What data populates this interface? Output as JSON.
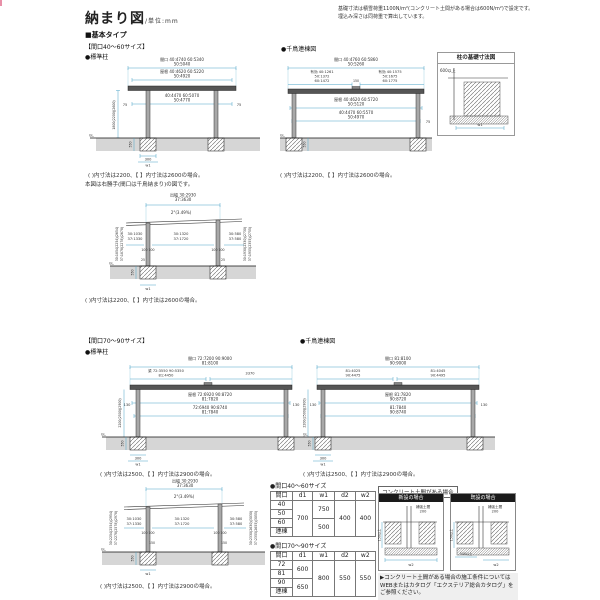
{
  "header": {
    "title": "納まり図",
    "unit": "/単位:mm",
    "note1": "基礎寸法は積雪荷重1100N/m²(コンクリート土間がある場合は600N/m²)で設定です。",
    "note2": "埋込み深さは同荷重で算出しています。"
  },
  "sections": {
    "basic": "■基本タイプ",
    "size4060": "【間口40～60サイズ】",
    "size7090": "【間口70～90サイズ】",
    "std_post": "●標準柱",
    "renketsu": "●千鳥連棟図",
    "std_post2": "●標準柱",
    "renketsu2": "●千鳥連棟図",
    "side_note": "本図は右勝手(間口は千鳥納まり)の図です。"
  },
  "d1": {
    "dim1a": "間口 40:4740 60:5340",
    "dim1b": "50:5040",
    "dim2a": "屋根 40:4620 60:5220",
    "dim2b": "50:4920",
    "dim3a": "40:4470 60:5070",
    "dim3b": "50:4770",
    "oh_l": "75",
    "oh_r": "75",
    "height": "1800(2200)(2600)",
    "gl": "GL.",
    "depth": "550",
    "base": "300",
    "w": "w1",
    "note": "( )内寸法は2200、【 】内寸法は2600の場合。"
  },
  "d2": {
    "dim1a": "間口 40:4760 60:5860",
    "dim1b": "50:5260",
    "subl1": "有効 40:1261",
    "subl2": "50:1372",
    "subl3": "60:1472",
    "subr1": "有効 40:1575",
    "subr2": "50:1675",
    "subr3": "60:1775",
    "mid": "150",
    "dim2a": "屋根 40:4620 60:5720",
    "dim2b": "50:5120",
    "dim3a": "40:4470 60:5570",
    "dim3b": "50:4970",
    "oh_r": "75",
    "gl": "GL.",
    "depth": "550",
    "note": "( )内寸法は2200、【 】内寸法は2600の場合。"
  },
  "detail": {
    "title": "柱の基礎寸法図",
    "min": "600以上",
    "w": "w1"
  },
  "d3": {
    "dim1a": "出幅 30:2930",
    "dim1b": "37:3630",
    "slope": "2°(3.49%)",
    "sl1": "30:1030",
    "sl2": "37:1330",
    "sc1": "30:1320",
    "sc2": "37:1720",
    "sr1": "30:580",
    "sr2": "37:580",
    "p1": "100  100",
    "p2": "100  100",
    "p25l": "25",
    "p25r": "25",
    "rotl1": "30:1854(2254)(2654)",
    "rotl2": "37:1878(2278)(2678)",
    "rotr1": "30:1930(2330)(2730)",
    "rotr2": "37:1955(2355)(2755)",
    "gl": "GL.",
    "depth": "550",
    "w": "w1",
    "note": "( )内寸法は2200、【 】内寸法は2600の場合。"
  },
  "d4l": {
    "dim1a": "間口 72:7200 90:9000",
    "dim1b": "81:8100",
    "subl1": "梁 72:3550 90:5350",
    "subl2": "81:4450",
    "subr": "3370",
    "dim2a": "屋根 72:6920 90:8720",
    "dim2b": "81:7820",
    "dim3a": "72:6940 90:8740",
    "dim3b": "81:7840",
    "oh_l": "130",
    "oh_r": "130",
    "height": "2200(2500)(2900)",
    "gl": "GL.",
    "depth": "550",
    "base": "300",
    "w": "w1",
    "note": "( )内寸法は2500、【 】内寸法は2900の場合。"
  },
  "d4r": {
    "dim1a": "間口 81:8100",
    "dim1b": "90:9000",
    "subl1": "81:4025",
    "subl2": "90:4475",
    "subr1": "81:4045",
    "subr2": "90:4495",
    "dim2a": "屋根 81:7820",
    "dim2b": "90:8720",
    "dim3a": "81:7840",
    "dim3b": "90:8740",
    "oh_l": "130",
    "oh_r": "130",
    "height": "2200(2500)(2900)",
    "gl": "GL.",
    "depth": "550",
    "base": "300",
    "w": "w1",
    "note": "( )内寸法は2500、【 】内寸法は2900の場合。"
  },
  "d5": {
    "dim1a": "出幅 30:2930",
    "dim1b": "37:3630",
    "slope": "2°(3.49%)",
    "sl1": "30:1030",
    "sl2": "37:1330",
    "sc1": "30:1320",
    "sc2": "37:1720",
    "sr1": "30:580",
    "sr2": "37:580",
    "p1": "100  100",
    "p2": "100  100",
    "p150l": "150",
    "p150r": "150",
    "rotl1": "30:2254(2554)(2954)",
    "rotl2": "37:2278(2578)(2978)",
    "rotr1": "30:2330(2630)(3030)",
    "rotr2": "37:2355(2655)(3055)",
    "gl": "GL.",
    "depth": "550",
    "w": "w1",
    "note": "( )内寸法は2500、【 】内寸法は2900の場合。"
  },
  "tables": {
    "a": {
      "title": "●間口40～60サイズ",
      "headers": [
        "間口",
        "d1",
        "w1",
        "d2",
        "w2"
      ],
      "rows": [
        "40",
        "50",
        "60",
        "連棟"
      ],
      "d1": "700",
      "w1a": "750",
      "w1b": "500",
      "d2": "400",
      "w2": "400"
    },
    "b": {
      "title": "●間口70～90サイズ",
      "headers": [
        "間口",
        "d1",
        "w1",
        "d2",
        "w2"
      ],
      "rows": [
        "72",
        "81",
        "90",
        "連棟"
      ],
      "d1a": "600",
      "d1b": "650",
      "w1": "800",
      "d2": "550",
      "w2": "550"
    }
  },
  "concrete": {
    "tab": "コンクリート土間がある場合",
    "box1": {
      "title": "新設の場合",
      "t1": "補強土間",
      "t2": "200",
      "side": "150以上",
      "w": "w2"
    },
    "box2": {
      "title": "既設の場合",
      "t1": "補強土間",
      "t2": "200",
      "side": "150以上",
      "b1": "500以上",
      "w": "w2"
    },
    "note": "▶コンクリート土間がある場合の施工条件についてはWEBまたはカタログ「エクステリア総合カタログ」をご参照ください。"
  }
}
